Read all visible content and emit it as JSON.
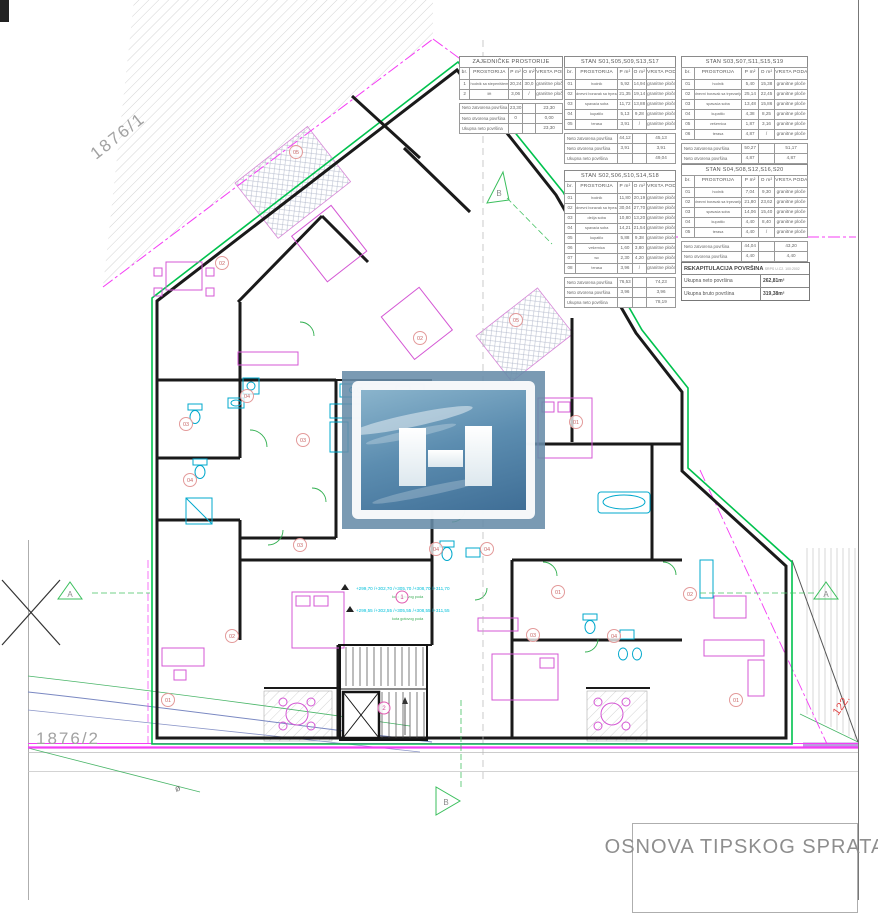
{
  "sheet": {
    "title": "OSNOVA TIPSKOG SPRATA",
    "parcel_upper": "1876/1",
    "parcel_lower": "1876/2",
    "elevation": "122.",
    "benchmark": "ø",
    "section_a": "A",
    "section_b": "B"
  },
  "tables": [
    {
      "id": "zajednicke",
      "title": "ZAJEDNIČKE PROSTORIJE",
      "columns": [
        "br.",
        "PROSTORIJA",
        "P m²",
        "O m²",
        "VRSTA PODA"
      ],
      "rows": [
        [
          "1",
          "hodnik sa stepeništem",
          "20,24",
          "30,0",
          "granitne ploče"
        ],
        [
          "2",
          "lift",
          "3,06",
          "/",
          "granitne ploče"
        ]
      ],
      "summary": [
        [
          "Neto zatvorena površina",
          "23,30",
          "",
          "23,30"
        ],
        [
          "Neto otvorena površina",
          "0",
          "",
          "0,00"
        ],
        [
          "Ukupna neto površina",
          "",
          "",
          "23,30"
        ]
      ]
    },
    {
      "id": "stan-s01",
      "title": "STAN S01,S05,S09,S13,S17",
      "columns": [
        "br.",
        "PROSTORIJA",
        "P m²",
        "O m²",
        "VRSTA PODA"
      ],
      "rows": [
        [
          "01",
          "hodnik",
          "5,92",
          "14,94",
          "granitne ploče"
        ],
        [
          "02",
          "dnevni boravak sa trpezarijom",
          "21,35",
          "19,14",
          "granitne ploče"
        ],
        [
          "03",
          "spavaća soba",
          "11,72",
          "13,88",
          "granitne ploče"
        ],
        [
          "04",
          "kupatilo",
          "5,13",
          "9,28",
          "granitne ploče"
        ],
        [
          "05",
          "terasa",
          "3,91",
          "/",
          "granitne ploče"
        ]
      ],
      "summary": [
        [
          "Neto zatvorena površina",
          "44,12",
          "",
          "45,13"
        ],
        [
          "Neto otvorena površina",
          "3,91",
          "",
          "3,91"
        ],
        [
          "Ukupna neto površina",
          "",
          "",
          "49,04"
        ]
      ]
    },
    {
      "id": "stan-s03",
      "title": "STAN S03,S07,S11,S15,S19",
      "columns": [
        "br.",
        "PROSTORIJA",
        "P m²",
        "O m²",
        "VRSTA PODA"
      ],
      "rows": [
        [
          "01",
          "hodnik",
          "5,40",
          "15,38",
          "granitne ploče"
        ],
        [
          "02",
          "dnevni boravak sa trpezarijom",
          "25,14",
          "22,45",
          "granitne ploče"
        ],
        [
          "03",
          "spavaća soba",
          "13,48",
          "15,86",
          "granitne ploče"
        ],
        [
          "04",
          "kupatilo",
          "4,38",
          "8,25",
          "granitne ploče"
        ],
        [
          "05",
          "vešernica",
          "1,87",
          "3,16",
          "granitne ploče"
        ],
        [
          "06",
          "terasa",
          "4,87",
          "/",
          "granitne ploče"
        ]
      ],
      "summary": [
        [
          "Neto zatvorena površina",
          "50,27",
          "",
          "51,17"
        ],
        [
          "Neto otvorena površina",
          "4,87",
          "",
          "4,87"
        ],
        [
          "Ukupna neto površina",
          "",
          "",
          "56,04"
        ]
      ]
    },
    {
      "id": "stan-s02",
      "title": "STAN S02,S06,S10,S14,S18",
      "columns": [
        "br.",
        "PROSTORIJA",
        "P m²",
        "O m²",
        "VRSTA PODA"
      ],
      "rows": [
        [
          "01",
          "hodnik",
          "11,80",
          "20,19",
          "granitne ploče"
        ],
        [
          "02",
          "dnevni boravak sa trpezarijom",
          "30,04",
          "27,70",
          "granitne ploče"
        ],
        [
          "03",
          "dečja soba",
          "10,80",
          "13,20",
          "granitne ploče"
        ],
        [
          "04",
          "spavaća soba",
          "14,21",
          "21,54",
          "granitne ploče"
        ],
        [
          "05",
          "kupatilo",
          "5,88",
          "9,38",
          "granitne ploče"
        ],
        [
          "06",
          "vešernica",
          "1,60",
          "3,80",
          "granitne ploče"
        ],
        [
          "07",
          "wc",
          "2,30",
          "4,20",
          "granitne ploče"
        ],
        [
          "08",
          "terasa",
          "3,96",
          "/",
          "granitne ploče"
        ]
      ],
      "summary": [
        [
          "Neto zatvorena površina",
          "76,53",
          "",
          "74,23"
        ],
        [
          "Neto otvorena površina",
          "3,96",
          "",
          "3,96"
        ],
        [
          "Ukupna neto površina",
          "",
          "",
          "78,19"
        ]
      ]
    },
    {
      "id": "stan-s04",
      "title": "STAN S04,S08,S12,S16,S20",
      "columns": [
        "br.",
        "PROSTORIJA",
        "P m²",
        "O m²",
        "VRSTA PODA"
      ],
      "rows": [
        [
          "01",
          "hodnik",
          "7,04",
          "9,30",
          "granitne ploče"
        ],
        [
          "02",
          "dnevni boravak sa trpezarijom",
          "21,80",
          "23,62",
          "granitne ploče"
        ],
        [
          "03",
          "spavaća soba",
          "14,06",
          "15,40",
          "granitne ploče"
        ],
        [
          "04",
          "kupatilo",
          "4,40",
          "8,40",
          "granitne ploče"
        ],
        [
          "05",
          "terasa",
          "4,40",
          "/",
          "granitne ploče"
        ]
      ],
      "summary": [
        [
          "Neto zatvorena površina",
          "44,04",
          "",
          "43,20"
        ],
        [
          "Neto otvorena površina",
          "4,40",
          "",
          "4,40"
        ],
        [
          "Ukupna neto površina",
          "",
          "",
          "47,60"
        ]
      ]
    }
  ],
  "recap": {
    "title": "REKAPITULACIJA POVRŠINA",
    "standard": "SRPS U.C2. 100:2002",
    "rows": [
      {
        "label": "Ukupna neto površina",
        "value": "262,81m²"
      },
      {
        "label": "Ukupna bruto površina",
        "value": "319,38m²"
      }
    ]
  },
  "annotations": {
    "levels_upper": "+299,70 /+302,70 /+305,70 /+308,70 /+311,70",
    "levels_upper_note": "kota gotovog poda",
    "levels_lower": "+299,55 /+302,55 /+305,55 /+308,55 /+311,55",
    "levels_lower_note": "kota gotovog poda"
  },
  "badges": {
    "rooms": [
      "05",
      "02",
      "03",
      "04",
      "04",
      "03",
      "03",
      "02",
      "01",
      "02",
      "05",
      "01",
      "01",
      "03",
      "04",
      "02",
      "01",
      "04",
      "04"
    ],
    "stairs": [
      "1",
      "2"
    ]
  },
  "colors": {
    "wall": "#1a1a1a",
    "facade_green": "#00c24e",
    "site_magenta": "#f43df4",
    "fixture_cyan": "#00a8cc",
    "furniture_magenta": "#d457d4",
    "badge_red": "#c96a6a",
    "watermark_blue": "#688ca8"
  }
}
